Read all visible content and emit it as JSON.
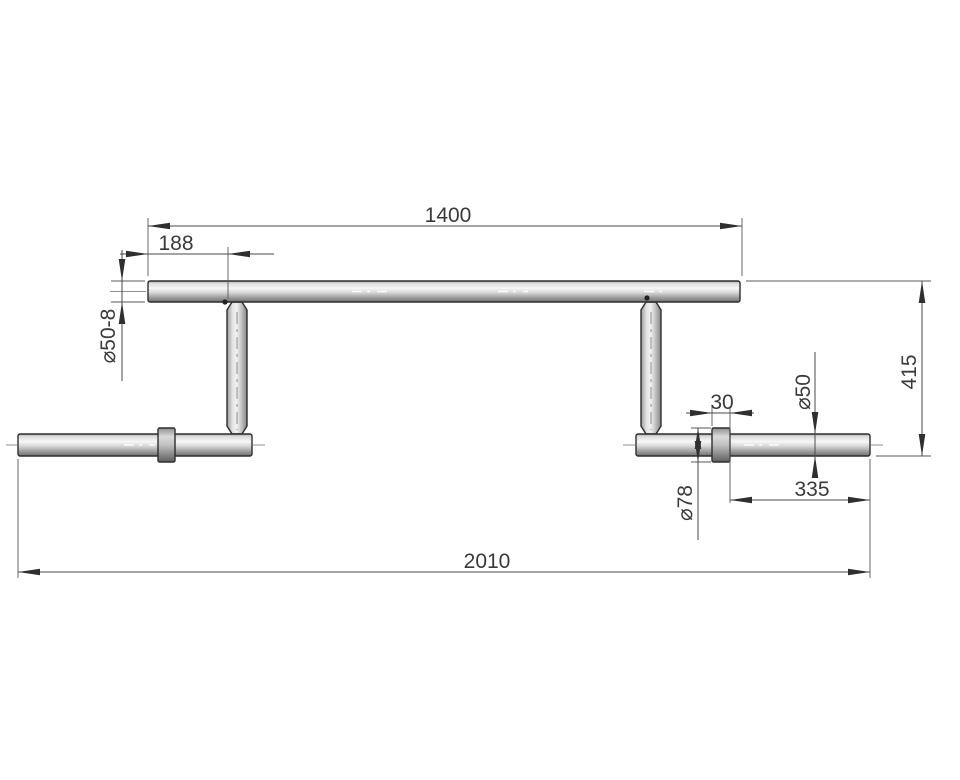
{
  "drawing": {
    "type": "technical-drawing",
    "subject": "camber-bar-front-view",
    "background": "#ffffff",
    "colors": {
      "outline": "#2e2e2e",
      "dimension_line": "#4a4a4a",
      "text": "#3a3a3a",
      "metal_highlight": "#f7f7f7",
      "metal_mid": "#d4d4d4",
      "metal_shadow": "#868686",
      "centerline": "#909090"
    },
    "dims": {
      "crossbar_length": "1400",
      "end_offset": "188",
      "bar_diameter": "⌀50-8",
      "drop_height": "415",
      "sleeve_diameter": "⌀50",
      "collar_width": "30",
      "collar_diameter": "⌀78",
      "sleeve_length": "335",
      "overall_length": "2010"
    }
  }
}
